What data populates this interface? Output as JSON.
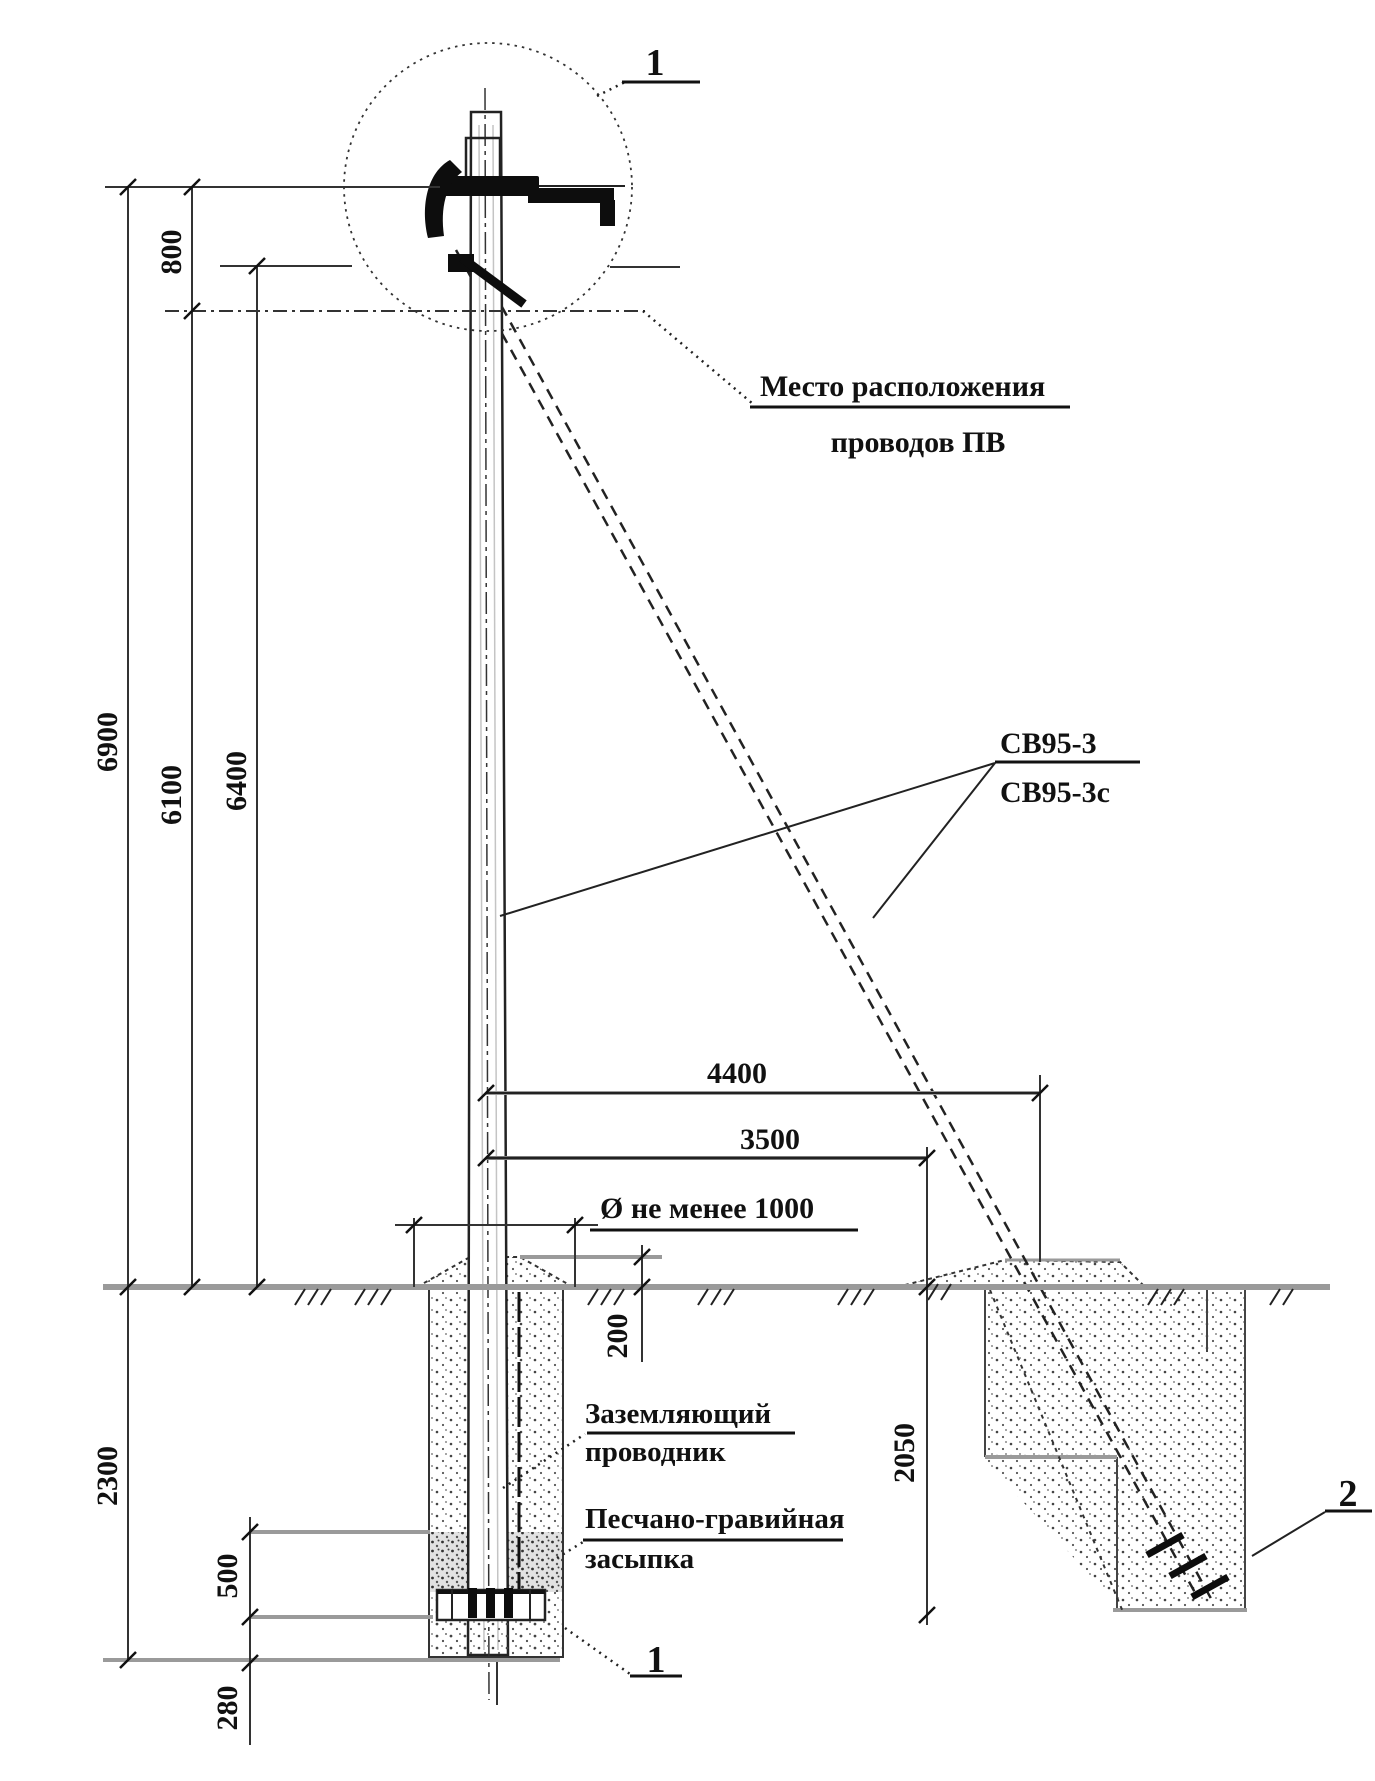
{
  "drawing": {
    "type": "pole-installation-elevation",
    "colors": {
      "ink": "#1a1a1a",
      "gray_line": "#9a9a9a",
      "background": "#ffffff"
    },
    "markers": {
      "node_top": "1",
      "node_bottom": "1",
      "node_anchor": "2"
    },
    "labels": {
      "pv_line1": "Место расположения",
      "pv_line2": "проводов ПВ",
      "pole_type1": "СВ95-3",
      "pole_type2": "СВ95-3с",
      "grounding1": "Заземляющий",
      "grounding2": "проводник",
      "backfill1": "Песчано-гравийная",
      "backfill2": "засыпка",
      "diameter_note": "Ø не менее 1000"
    },
    "dims": {
      "top_to_wires": "800",
      "total_height": "6900",
      "wires_height": "6100",
      "strut_height": "6400",
      "anchor_offset": "4400",
      "pit_offset": "3500",
      "mound_height": "200",
      "embed_depth": "2300",
      "gravel_layer": "500",
      "base_layer": "280",
      "anchor_depth": "2050"
    }
  }
}
